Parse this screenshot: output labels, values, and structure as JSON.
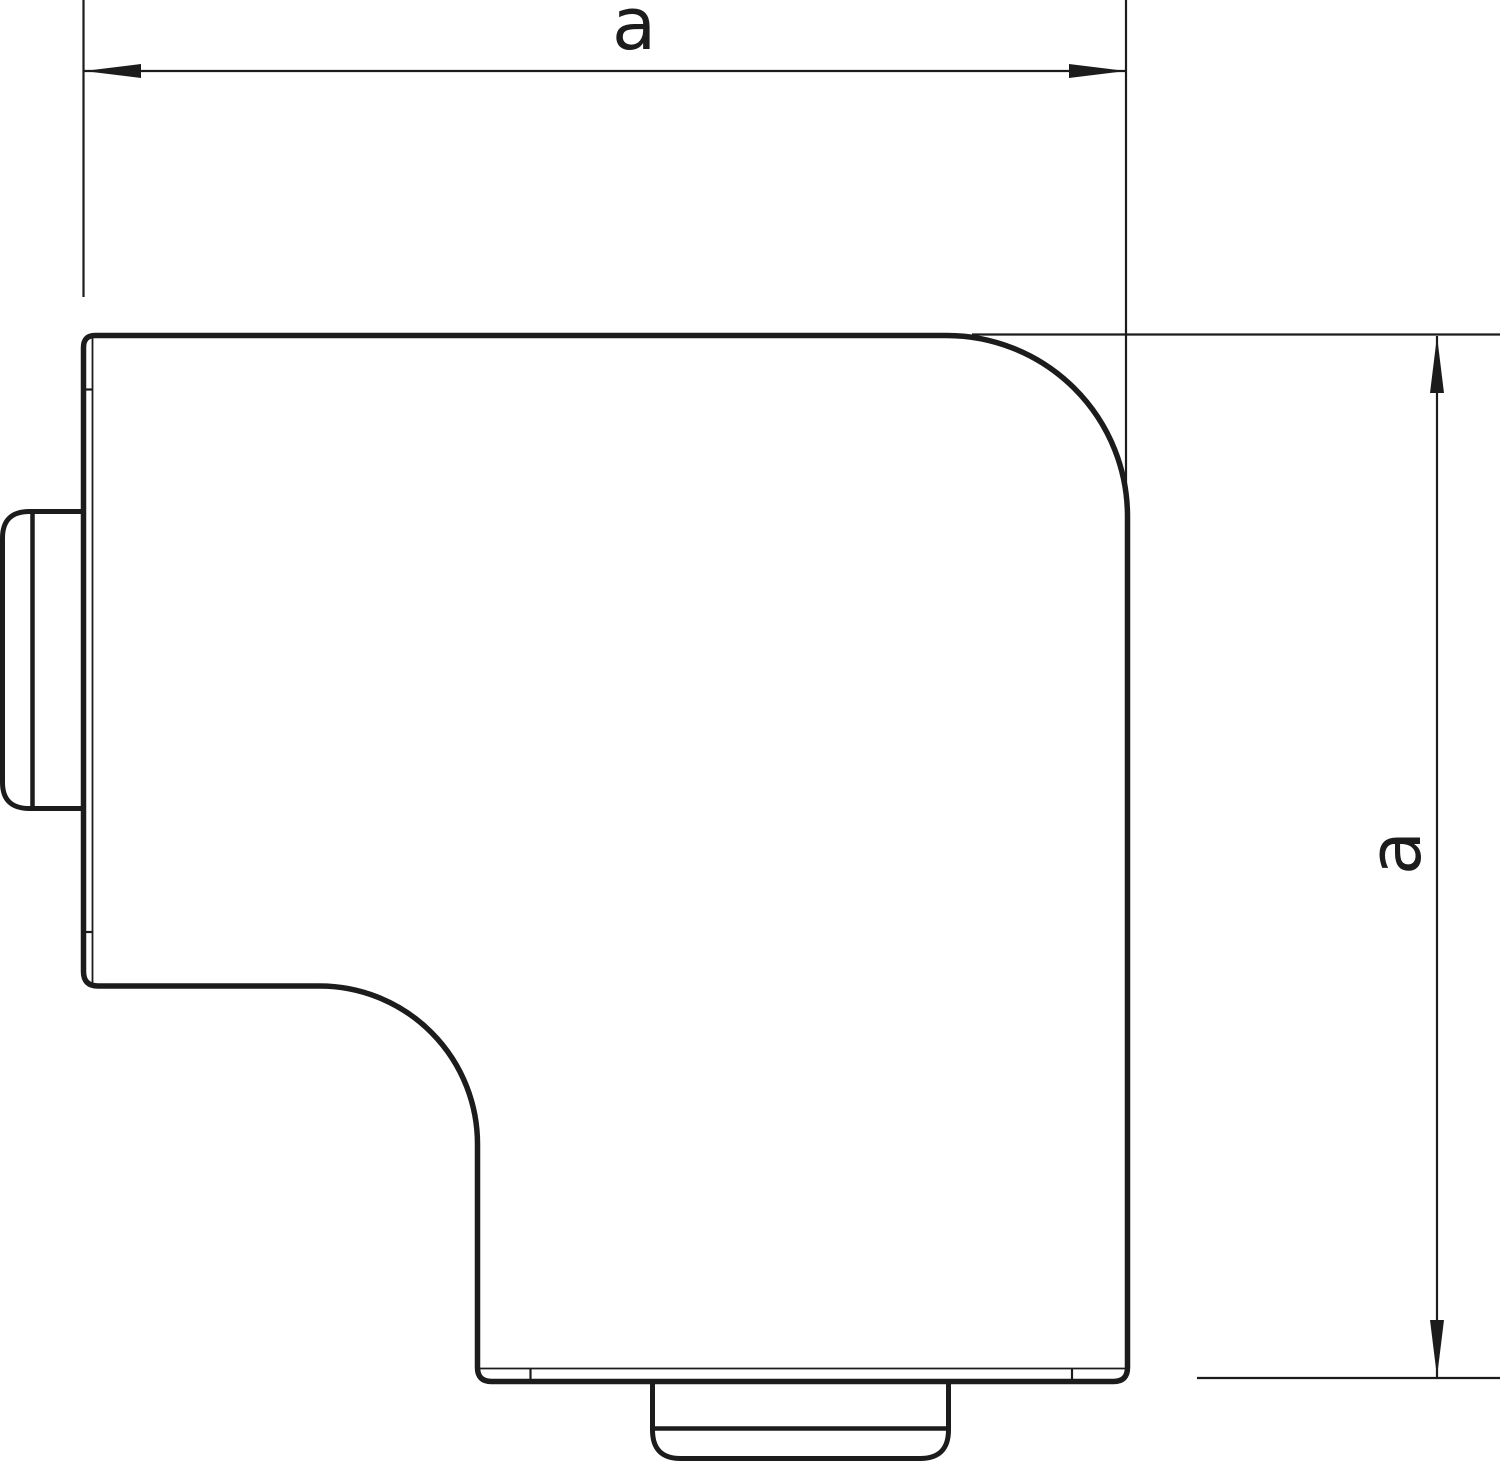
{
  "drawing": {
    "kind": "technical dimensional drawing, flat angle trunking cover, front view",
    "line_color": "#1c1c1c",
    "fill_color": "#ffffff",
    "background_color": "#ffffff",
    "dimension_horizontal": {
      "label": "a"
    },
    "dimension_vertical": {
      "label": "a"
    }
  }
}
